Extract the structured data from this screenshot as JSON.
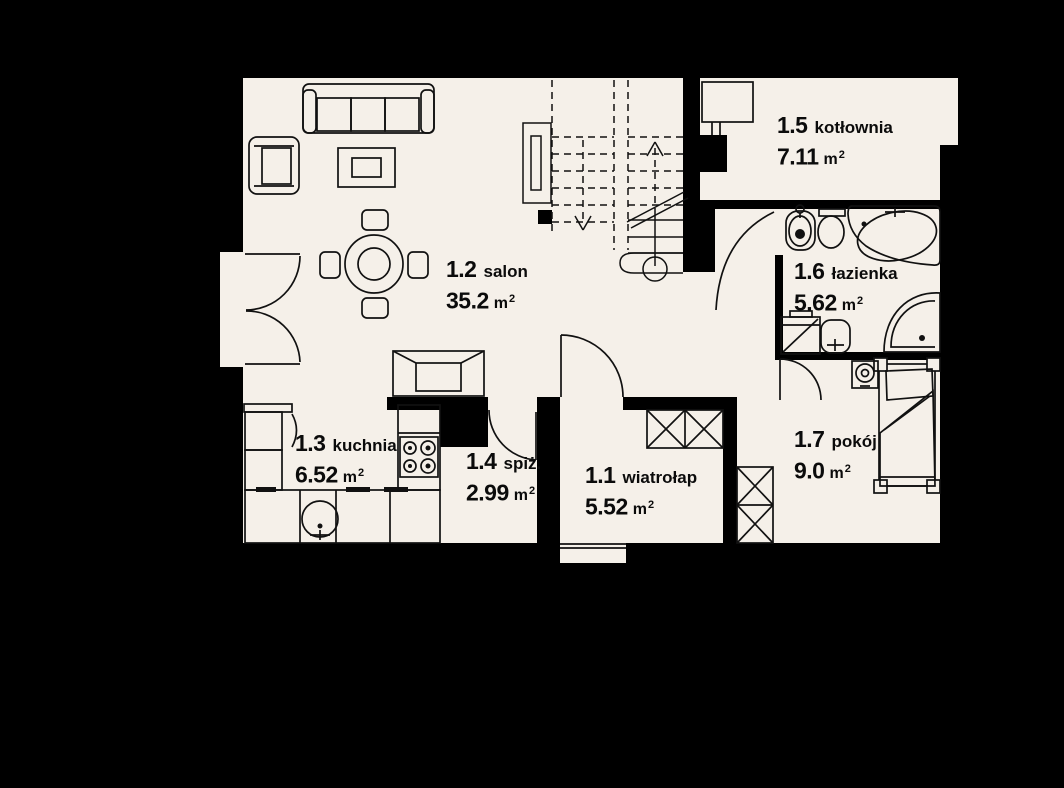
{
  "rooms": [
    {
      "id": "1.1",
      "name": "wiatrołap",
      "area": "5.52"
    },
    {
      "id": "1.2",
      "name": "salon",
      "area": "35.2"
    },
    {
      "id": "1.3",
      "name": "kuchnia",
      "area": "6.52"
    },
    {
      "id": "1.4",
      "name": "spiż.",
      "area": "2.99"
    },
    {
      "id": "1.5",
      "name": "kotłownia",
      "area": "7.11"
    },
    {
      "id": "1.6",
      "name": "łazienka",
      "area": "5.62"
    },
    {
      "id": "1.7",
      "name": "pokój",
      "area": "9.0"
    }
  ],
  "units": {
    "area": "m",
    "exp": "2"
  },
  "colors": {
    "background": "#000000",
    "floor": "#f5f0e9",
    "wall": "#000000",
    "line": "#111111",
    "text": "#0b0b0b"
  }
}
